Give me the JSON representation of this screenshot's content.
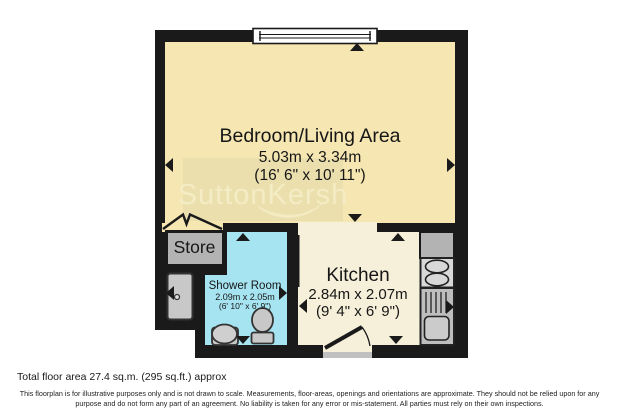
{
  "plan": {
    "watermark": "SuttonKersh",
    "rooms": {
      "bedroom": {
        "name": "Bedroom/Living Area",
        "metric": "5.03m x 3.34m",
        "imperial": "(16' 6\" x 10' 11\")"
      },
      "store": {
        "name": "Store"
      },
      "shower": {
        "name": "Shower Room",
        "metric": "2.09m x 2.05m",
        "imperial": "(6' 10\" x 6' 9\")"
      },
      "kitchen": {
        "name": "Kitchen",
        "metric": "2.84m x 2.07m",
        "imperial": "(9' 4\" x 6' 9\")"
      }
    },
    "colors": {
      "wall": "#1a1a1a",
      "bedroom_fill": "#f6e7b2",
      "kitchen_fill": "#f6f0da",
      "shower_fill": "#a7e4f1",
      "store_fill": "#b3b3b3",
      "fixture_fill": "#c8c8c8",
      "hob_fill": "#d8d8d8",
      "sink_unit_fill": "#bebebe",
      "watermark_box": "#ebdfae",
      "watermark_text": "#f4ecc4"
    }
  },
  "footer": {
    "total_area": "Total floor area 27.4 sq.m. (295 sq.ft.) approx",
    "disclaimer_line1": "This floorplan is for illustrative purposes only and is not drawn to scale. Measurements, floor-areas, openings and orientations are approximate. They should not be relied upon for any",
    "disclaimer_line2": "purpose and do not form any part of an agreement. No liability is taken for any error or mis-statement. All parties must rely on their own inspections."
  }
}
